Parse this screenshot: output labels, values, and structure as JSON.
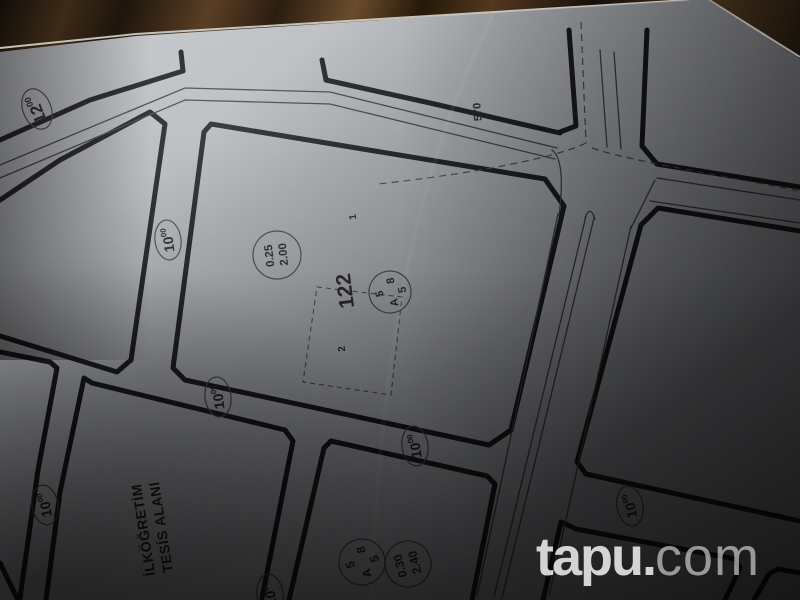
{
  "plan": {
    "block_number": "122",
    "parcel_1": "1",
    "parcel_2": "2",
    "boundary_number": "570",
    "facility_area": {
      "line1": "İLKÖĞRETİM",
      "line2": "TESİS ALANI"
    },
    "road_width_10": {
      "value": "10",
      "sup": "00"
    },
    "road_width_12": {
      "value": "12",
      "sup": "00"
    },
    "zoning_circle": {
      "top": "5",
      "right": "8",
      "bottom": "5",
      "left": "A"
    },
    "ratios_block_122": {
      "taks": "0.25",
      "kaks": "2.00"
    },
    "ratios_block_south": {
      "taks": "0.30",
      "kaks": "2.40"
    }
  },
  "watermark": {
    "bold": "tapu.",
    "light": "com"
  },
  "colors": {
    "paper": "#b6b9bd",
    "ink": "#17181b",
    "wood": "#2a1d10",
    "watermark": "#eceded"
  }
}
